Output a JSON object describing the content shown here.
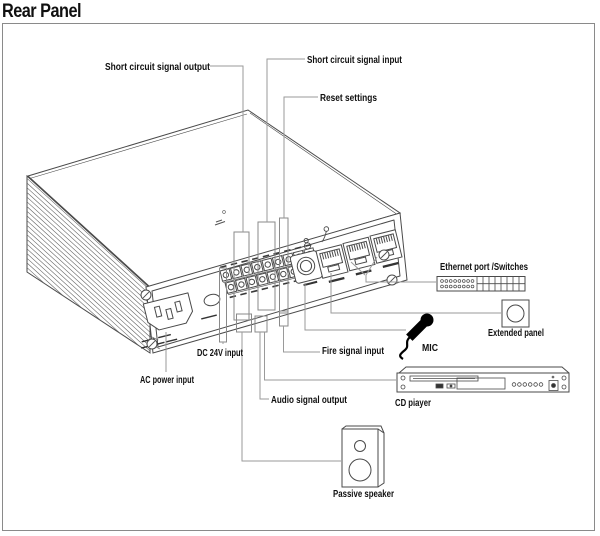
{
  "title": "Rear Panel",
  "colors": {
    "outline": "#4a4a4a",
    "leader": "#9a9a9a",
    "frame": "#8a8a8a",
    "label": "#101010",
    "black": "#000000",
    "fill": "#ffffff"
  },
  "labels": {
    "short_circuit_signal_output": "Short circuit signal output",
    "short_circuit_signal_input": "Short circuit signal input",
    "reset_settings": "Reset settings",
    "dc_24v_input": "DC 24V input",
    "ac_power_input": "AC power input",
    "audio_signal_output": "Audio signal output",
    "fire_signal_input": "Fire signal input",
    "mic": "MIC",
    "ethernet_port_switches": "Ethernet port /Switches",
    "extended_panel": "Extended panel",
    "cd_player": "CD piayer",
    "passive_speaker": "Passive speaker"
  }
}
